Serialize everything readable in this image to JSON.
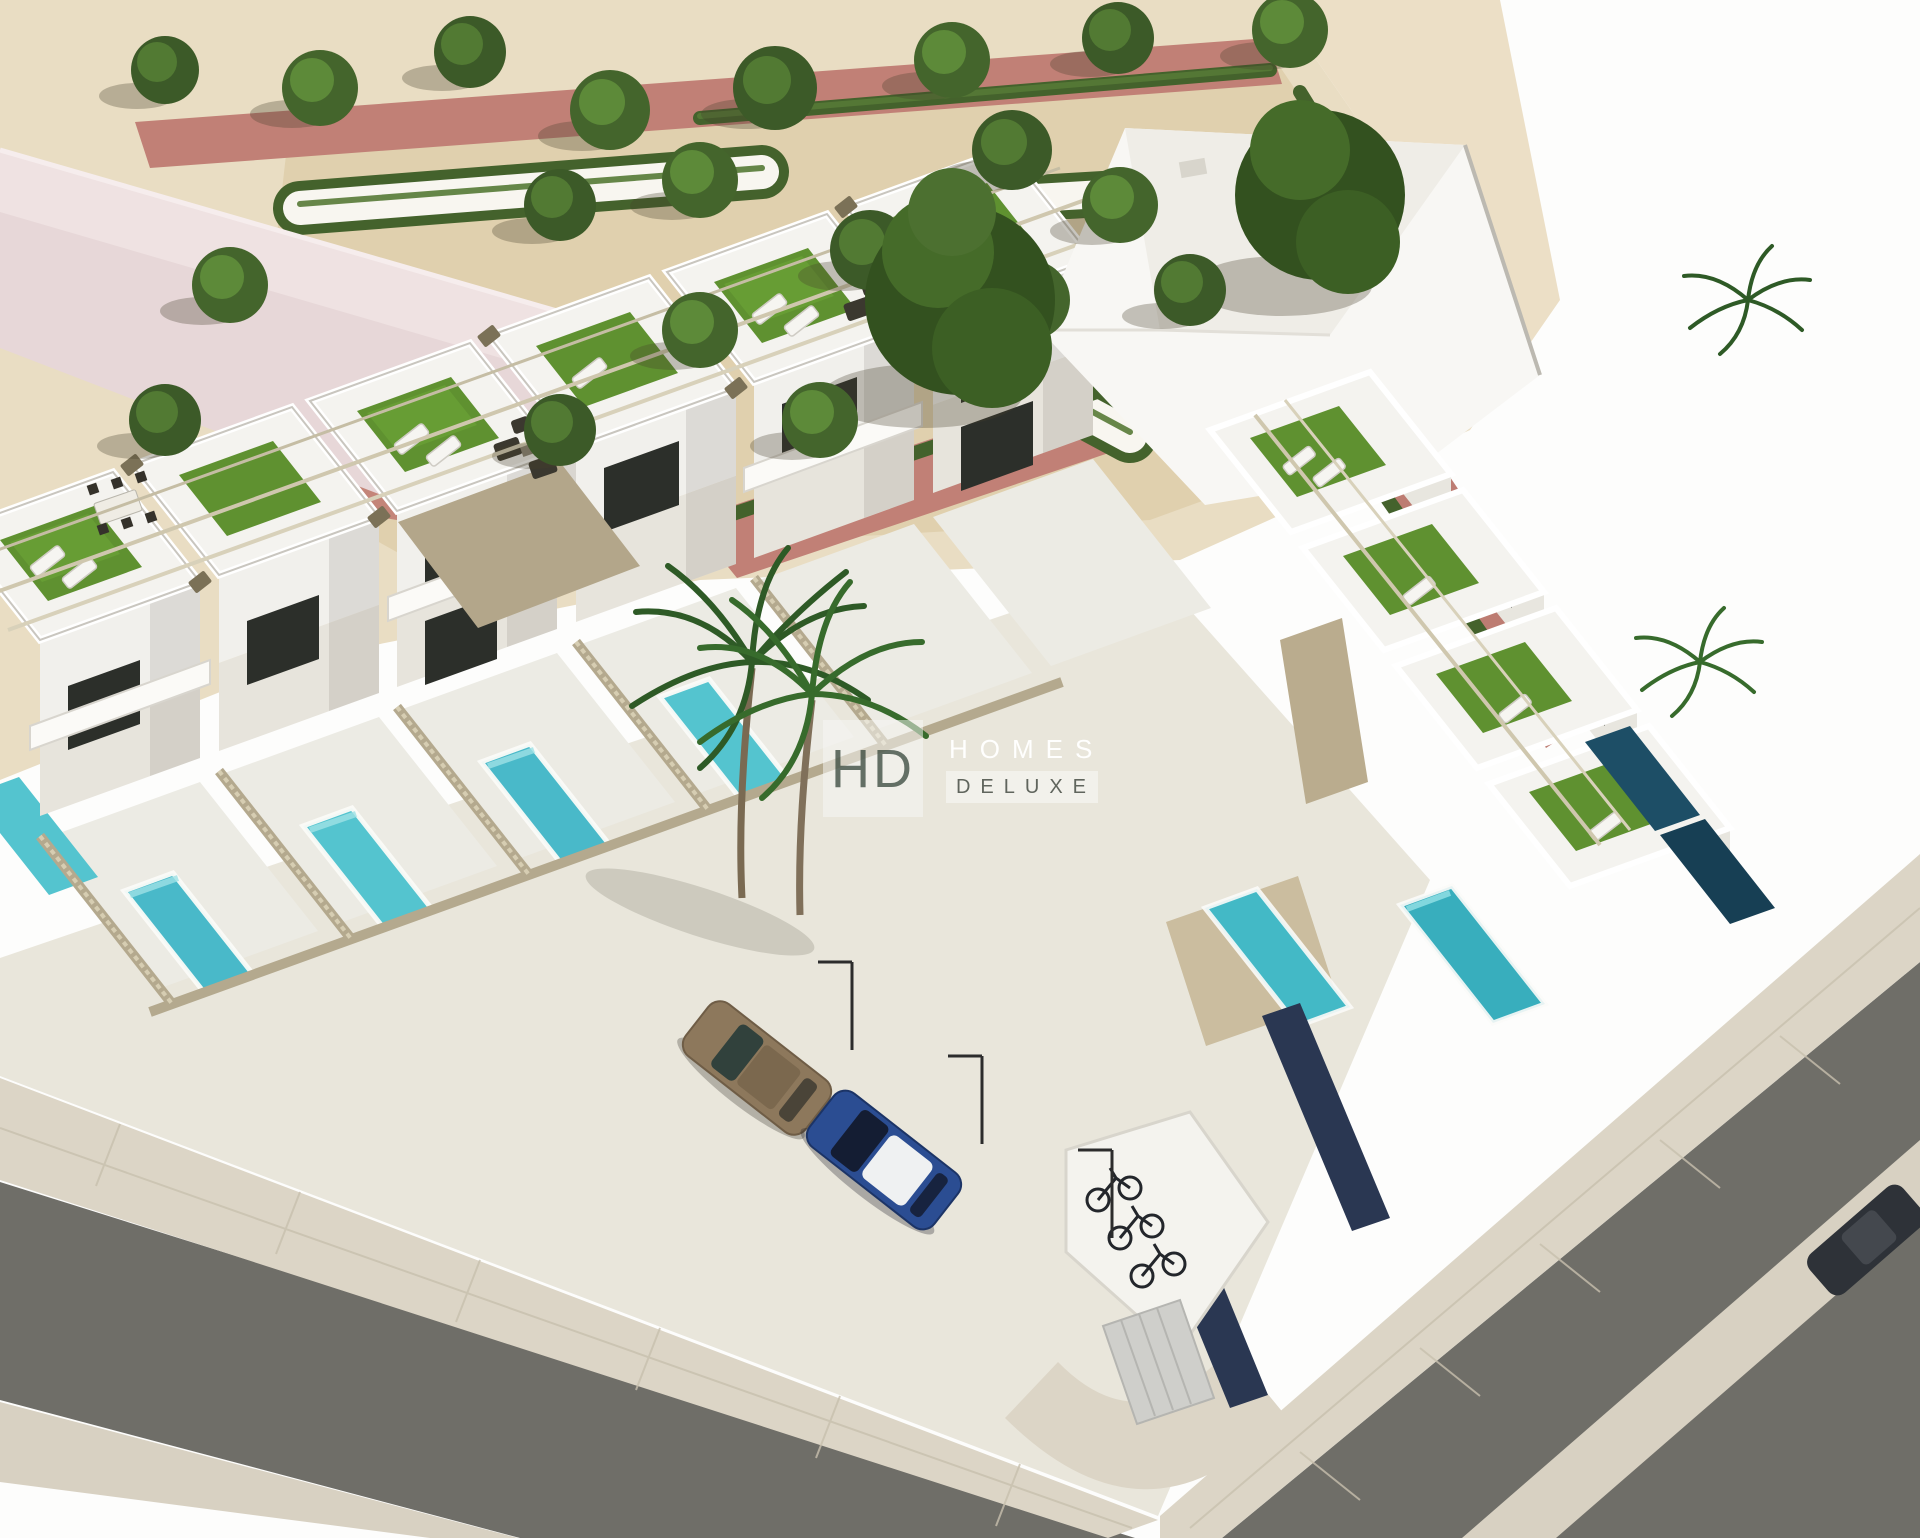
{
  "image": {
    "description": "Aerial 3D architectural render of a modern white townhouse development on a street corner, with rooftop solariums (artificial turf, sun loungers, pergolas), private turquoise pools, palm trees, parked cars, bicycle parking, and a formal landscaped park with hedges, red brick paths and trees."
  },
  "watermark": {
    "monogram": "HD",
    "line1": "HOMES",
    "line2": "DELUXE"
  },
  "palette": {
    "sand": "#e9ddc3",
    "park_gravel": "#e0d0ae",
    "red_brick_path": "#c18076",
    "white_path": "#f8f6f0",
    "hedge_green": "#44622c",
    "tree_green": "#3c5a28",
    "building_white": "#f4f3ef",
    "wall_shadow": "#d7d4cd",
    "window_glass": "#2c2f2a",
    "roof_terrace_turf": "#5f9130",
    "pool_turquoise": "#49b9c9",
    "pool_shadowed": "#1d4e66",
    "asphalt_road": "#6f6e68",
    "sidewalk": "#dcd5c6",
    "parking_court": "#e9e6db",
    "fence_beige": "#b4a98e",
    "boundary_wall_navy": "#2a3752",
    "car_bronze": "#8d785c",
    "car_blue": "#2b4d92",
    "car_roof_white": "#eff1f2",
    "roof_pink": "#e7d7d8",
    "stair_panel_taupe": "#b3a68a"
  }
}
